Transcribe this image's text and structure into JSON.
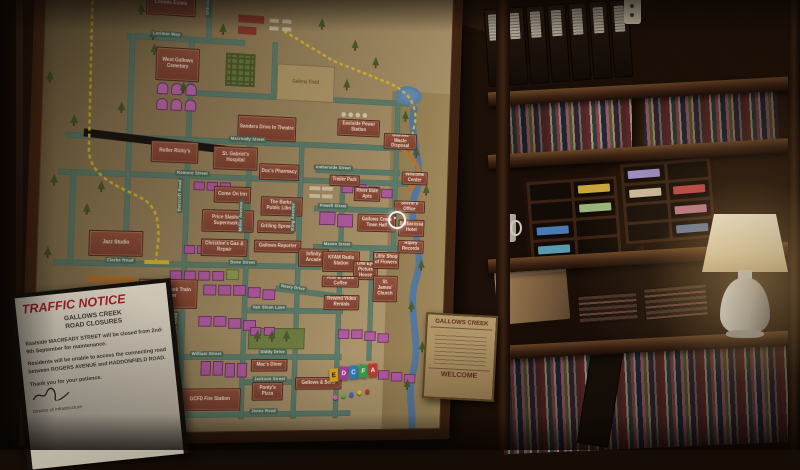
{
  "map": {
    "palette": {
      "paper": "#a9936a",
      "building": "#8a4a38",
      "house": "#b05aa0",
      "road": "#5e7d6b",
      "closed_road": "#191410",
      "detour_route": "#d8b92a",
      "river": "#54779e",
      "rail": "#b8742c"
    },
    "buildings": [
      {
        "label": "Loomis Estate",
        "css": "left:114px;top:42px;width:52px;height:24px"
      },
      {
        "label": "West Gallows Cemetary",
        "css": "left:126px;top:98px;width:46px;height:34px"
      },
      {
        "label": "Roller Ricky's",
        "css": "left:124px;top:193px;width:50px;height:22px"
      },
      {
        "label": "Jazz Studio",
        "css": "left:63px;top:285px;width:56px;height:26px"
      },
      {
        "label": "Gallows Creek Train Station",
        "css": "left:116px;top:333px;width:62px;height:30px"
      },
      {
        "label": "Sanders Drive In Theatre",
        "css": "left:215px;top:163px;width:64px;height:26px"
      },
      {
        "label": "St. Gabriel's Hospital",
        "css": "left:190px;top:196px;width:48px;height:24px"
      },
      {
        "label": "Doc's Pharmacy",
        "css": "left:240px;top:212px;width:44px;height:17px"
      },
      {
        "label": "Come On Inn",
        "css": "left:192px;top:237px;width:40px;height:17px"
      },
      {
        "label": "Price Slashers Supermarket",
        "css": "left:180px;top:261px;width:56px;height:23px"
      },
      {
        "label": "Christine's Gas & Repair",
        "css": "left:180px;top:291px;width:50px;height:18px"
      },
      {
        "label": "The Barker Public Library",
        "css": "left:243px;top:246px;width:46px;height:20px"
      },
      {
        "label": "Grilling Spree",
        "css": "left:240px;top:271px;width:40px;height:13px"
      },
      {
        "label": "Gallows Reporter",
        "css": "left:237px;top:291px;width:52px;height:13px"
      },
      {
        "label": "Eastside Power Station",
        "css": "left:325px;top:162px;width:48px;height:18px"
      },
      {
        "label": "Trailer Park",
        "css": "left:318px;top:221px;width:34px;height:12px"
      },
      {
        "label": "Gallows Waste Disposal",
        "css": "left:378px;top:175px;width:38px;height:17px"
      },
      {
        "label": "Welcome Center",
        "css": "left:400px;top:215px;width:30px;height:14px"
      },
      {
        "label": "River Side Apts",
        "css": "left:346px;top:233px;width:30px;height:15px"
      },
      {
        "label": "Gallows Creek Town Hall",
        "css": "left:351px;top:261px;width:44px;height:19px"
      },
      {
        "label": "Barbarossa Hotel",
        "css": "left:398px;top:266px;width:30px;height:18px"
      },
      {
        "label": "Ripley Records",
        "css": "left:398px;top:288px;width:30px;height:14px"
      },
      {
        "label": "Sheriff's Office",
        "css": "left:392px;top:246px;width:36px;height:13px"
      },
      {
        "label": "Infinity Arcade",
        "css": "left:286px;top:299px;width:34px;height:19px"
      },
      {
        "label": "KFAM Radio Station",
        "css": "left:313px;top:301px;width:42px;height:22px"
      },
      {
        "label": "One Eye Picture House",
        "css": "left:348px;top:311px;width:28px;height:20px"
      },
      {
        "label": "Little Shop of Flowers",
        "css": "left:370px;top:301px;width:30px;height:18px"
      },
      {
        "label": "Rise & Shine Coffee",
        "css": "left:313px;top:327px;width:42px;height:12px"
      },
      {
        "label": "St. James' Church",
        "css": "left:371px;top:326px;width:28px;height:28px"
      },
      {
        "label": "Rewind Video Rentals",
        "css": "left:316px;top:347px;width:40px;height:16px"
      },
      {
        "label": "Mac's Diner",
        "css": "left:238px;top:414px;width:40px;height:13px"
      },
      {
        "label": "Ponty's Pizza",
        "css": "left:240px;top:438px;width:34px;height:19px"
      },
      {
        "label": "GCFD Fire Station",
        "css": "left:162px;top:444px;width:66px;height:23px"
      },
      {
        "label": "Gallows & Sons",
        "css": "left:287px;top:433px;width:52px;height:13px"
      },
      {
        "label": "Galens Field",
        "cls": "field",
        "css": "left:256px;top:108px;width:64px;height:38px"
      }
    ],
    "streets": [
      {
        "label": "Lorimer Way",
        "css": "left:120px;top:82px"
      },
      {
        "label": "Oldridge Road",
        "cls": "vert",
        "css": "left:176px;top:28px"
      },
      {
        "label": "Macready Street",
        "css": "left:206px;top:185px"
      },
      {
        "label": "Romero Street",
        "css": "left:150px;top:222px"
      },
      {
        "label": "Barcroft Road",
        "cls": "vert",
        "css": "left:153px;top:230px"
      },
      {
        "label": "Miller Avenue",
        "cls": "vert",
        "css": "left:219px;top:250px"
      },
      {
        "label": "King Avenue",
        "cls": "vert",
        "css": "left:276px;top:250px"
      },
      {
        "label": "Clarke Road",
        "css": "left:80px;top:312px"
      },
      {
        "label": "Bone Street",
        "css": "left:210px;top:312px"
      },
      {
        "label": "Thorndale Road",
        "cls": "vert",
        "css": "left:153px;top:365px"
      },
      {
        "label": "Van Sloan Lane",
        "css": "left:236px;top:358px"
      },
      {
        "label": "Neary Drive",
        "css": "left:266px;top:337px;transform:rotate(7deg)"
      },
      {
        "label": "William Street",
        "css": "left:172px;top:406px"
      },
      {
        "label": "Diddy Drive",
        "css": "left:246px;top:404px"
      },
      {
        "label": "Jackson Street",
        "css": "left:240px;top:432px"
      },
      {
        "label": "Jones Road",
        "css": "left:238px;top:465px"
      },
      {
        "label": "Mason Street",
        "css": "left:312px;top:291px"
      },
      {
        "label": "Powell Street",
        "css": "left:306px;top:251px"
      },
      {
        "label": "Amberside Street",
        "css": "left:300px;top:211px"
      }
    ],
    "roads": [
      {
        "css": "left:95px;top:86px;width:125px;height:6px"
      },
      {
        "css": "left:160px;top:140px;width:246px;height:6px"
      },
      {
        "css": "left:36px;top:188px;width:372px;height:6px"
      },
      {
        "css": "left:30px;top:225px;width:378px;height:6px"
      },
      {
        "css": "left:28px;top:315px;width:284px;height:6px"
      },
      {
        "css": "left:228px;top:361px;width:110px;height:6px"
      },
      {
        "css": "left:148px;top:409px;width:190px;height:6px"
      },
      {
        "css": "left:228px;top:435px;width:110px;height:6px"
      },
      {
        "css": "left:148px;top:468px;width:202px;height:6px"
      },
      {
        "css": "left:262px;top:342px;width:76px;height:6px;transform:rotate(6deg)"
      },
      {
        "css": "left:302px;top:294px;width:96px;height:6px"
      },
      {
        "css": "left:302px;top:254px;width:96px;height:6px"
      },
      {
        "css": "left:302px;top:214px;width:96px;height:6px"
      },
      {
        "css": "left:98px;top:86px;width:6px;height:234px"
      },
      {
        "css": "left:160px;top:86px;width:6px;height:390px"
      },
      {
        "css": "left:226px;top:188px;width:6px;height:288px"
      },
      {
        "css": "left:283px;top:188px;width:6px;height:288px"
      },
      {
        "css": "left:330px;top:214px;width:6px;height:262px"
      },
      {
        "css": "left:366px;top:294px;width:6px;height:122px"
      },
      {
        "css": "left:178px;top:14px;width:6px;height:76px"
      },
      {
        "css": "left:390px;top:140px;width:6px;height:158px"
      },
      {
        "css": "left:250px;top:86px;width:6px;height:58px"
      },
      {
        "css": "left:42px;top:225px;width:6px;height:94px"
      }
    ],
    "deco": [
      {
        "cls": "band",
        "css": "left:386px;top:130px;width:67px;height:359px"
      },
      {
        "cls": "lake",
        "css": "left:390px;top:124px;width:30px;height:20px"
      },
      {
        "cls": "maze",
        "css": "left:200px;top:100px;width:32px;height:34px"
      },
      {
        "cls": "park",
        "css": "left:234px;top:382px;width:62px;height:22px"
      },
      {
        "cls": "redbox",
        "css": "left:212px;top:60px;width:28px;height:8px"
      },
      {
        "cls": "redbox",
        "css": "left:212px;top:72px;width:20px;height:8px"
      },
      {
        "cls": "wbar",
        "css": "left:246px;top:62px;width:10px;height:4px"
      },
      {
        "cls": "wbar",
        "css": "left:260px;top:62px;width:10px;height:4px"
      },
      {
        "cls": "wbar",
        "css": "left:246px;top:70px;width:10px;height:4px"
      },
      {
        "cls": "wbar",
        "css": "left:260px;top:70px;width:10px;height:4px"
      },
      {
        "cls": "wbar",
        "css": "left:296px;top:234px;width:12px;height:4px"
      },
      {
        "cls": "wbar",
        "css": "left:310px;top:234px;width:12px;height:4px"
      },
      {
        "cls": "wbar",
        "css": "left:296px;top:242px;width:12px;height:4px"
      },
      {
        "cls": "wbar",
        "css": "left:310px;top:242px;width:12px;height:4px"
      },
      {
        "cls": "dot",
        "css": "left:329px;top:155px;width:5px;height:5px"
      },
      {
        "cls": "dot",
        "css": "left:337px;top:155px;width:5px;height:5px"
      },
      {
        "cls": "dot",
        "css": "left:345px;top:155px;width:5px;height:5px"
      },
      {
        "cls": "dot",
        "css": "left:353px;top:155px;width:5px;height:5px"
      },
      {
        "cls": "rail",
        "css": "left:62px;top:331px;width:50px;height:6px"
      },
      {
        "cls": "rail",
        "css": "left:84px;top:331px;width:8px;height:44px"
      },
      {
        "cls": "closed",
        "css": "left:54px;top:190px;width:154px;height:8px;transform:rotate(4.5deg)"
      }
    ],
    "houses": [
      {
        "cls": "tomb",
        "css": "left:128px;top:134px;width:12px;height:12px"
      },
      {
        "cls": "tomb",
        "css": "left:143px;top:134px;width:12px;height:12px"
      },
      {
        "cls": "tomb",
        "css": "left:158px;top:134px;width:12px;height:12px"
      },
      {
        "cls": "tomb",
        "css": "left:128px;top:150px;width:12px;height:12px"
      },
      {
        "cls": "tomb",
        "css": "left:143px;top:150px;width:12px;height:12px"
      },
      {
        "cls": "tomb",
        "css": "left:158px;top:150px;width:12px;height:12px"
      },
      {
        "css": "left:170px;top:233px;width:12px;height:9px"
      },
      {
        "css": "left:184px;top:233px;width:12px;height:9px"
      },
      {
        "css": "left:198px;top:233px;width:12px;height:9px"
      },
      {
        "css": "left:162px;top:298px;width:12px;height:9px"
      },
      {
        "css": "left:176px;top:298px;width:12px;height:9px"
      },
      {
        "css": "left:190px;top:298px;width:12px;height:9px"
      },
      {
        "css": "left:148px;top:324px;width:13px;height:10px"
      },
      {
        "css": "left:163px;top:324px;width:13px;height:10px"
      },
      {
        "css": "left:178px;top:324px;width:13px;height:10px"
      },
      {
        "css": "left:193px;top:324px;width:13px;height:10px"
      },
      {
        "cls": "park2",
        "css": "left:208px;top:322px;width:14px;height:11px"
      },
      {
        "css": "left:184px;top:338px;width:14px;height:11px"
      },
      {
        "css": "left:200px;top:338px;width:14px;height:11px"
      },
      {
        "css": "left:216px;top:338px;width:14px;height:11px"
      },
      {
        "css": "left:232px;top:340px;width:14px;height:11px"
      },
      {
        "css": "left:248px;top:342px;width:14px;height:11px"
      },
      {
        "css": "left:180px;top:370px;width:14px;height:11px"
      },
      {
        "css": "left:196px;top:370px;width:14px;height:11px"
      },
      {
        "css": "left:212px;top:372px;width:14px;height:11px"
      },
      {
        "css": "left:228px;top:374px;width:14px;height:11px"
      },
      {
        "css": "left:184px;top:416px;width:11px;height:15px"
      },
      {
        "css": "left:197px;top:416px;width:11px;height:15px"
      },
      {
        "css": "left:210px;top:418px;width:11px;height:15px"
      },
      {
        "css": "left:223px;top:418px;width:11px;height:15px"
      },
      {
        "css": "left:56px;top:446px;width:13px;height:11px"
      },
      {
        "css": "left:72px;top:446px;width:13px;height:11px"
      },
      {
        "css": "left:88px;top:448px;width:13px;height:11px"
      },
      {
        "css": "left:104px;top:448px;width:13px;height:11px"
      },
      {
        "css": "left:40px;top:478px;width:13px;height:11px"
      },
      {
        "css": "left:58px;top:478px;width:13px;height:11px"
      },
      {
        "css": "left:76px;top:480px;width:13px;height:11px"
      },
      {
        "css": "left:332px;top:230px;width:13px;height:10px"
      },
      {
        "css": "left:347px;top:230px;width:13px;height:10px"
      },
      {
        "css": "left:362px;top:232px;width:13px;height:10px"
      },
      {
        "css": "left:377px;top:234px;width:13px;height:10px"
      },
      {
        "css": "left:308px;top:260px;width:18px;height:14px"
      },
      {
        "css": "left:328px;top:262px;width:18px;height:14px"
      },
      {
        "css": "left:333px;top:383px;width:13px;height:10px"
      },
      {
        "css": "left:348px;top:383px;width:13px;height:10px"
      },
      {
        "css": "left:363px;top:385px;width:13px;height:10px"
      },
      {
        "css": "left:378px;top:387px;width:13px;height:10px"
      },
      {
        "css": "left:380px;top:426px;width:13px;height:10px"
      },
      {
        "css": "left:395px;top:428px;width:13px;height:10px"
      },
      {
        "css": "left:410px;top:430px;width:13px;height:10px"
      },
      {
        "css": "left:236px;top:381px;width:12px;height:9px"
      },
      {
        "css": "left:251px;top:381px;width:12px;height:9px"
      }
    ],
    "trees": [
      {
        "css": "left:14px;top:128px"
      },
      {
        "css": "left:40px;top:170px"
      },
      {
        "css": "left:22px;top:230px"
      },
      {
        "css": "left:56px;top:258px"
      },
      {
        "css": "left:18px;top:302px"
      },
      {
        "css": "left:70px;top:235px"
      },
      {
        "css": "left:88px;top:155px"
      },
      {
        "css": "left:118px;top:80px"
      },
      {
        "css": "left:105px;top:55px"
      },
      {
        "css": "left:152px;top:132px"
      },
      {
        "css": "left:120px;top:95px"
      },
      {
        "css": "left:192px;top:70px"
      },
      {
        "css": "left:300px;top:58px"
      },
      {
        "css": "left:338px;top:78px"
      },
      {
        "css": "left:362px;top:95px"
      },
      {
        "css": "left:330px;top:120px"
      },
      {
        "css": "left:398px;top:150px"
      },
      {
        "css": "left:412px;top:188px"
      },
      {
        "css": "left:425px;top:228px"
      },
      {
        "css": "left:408px;top:268px"
      },
      {
        "css": "left:422px;top:308px"
      },
      {
        "css": "left:412px;top:352px"
      },
      {
        "css": "left:426px;top:395px"
      },
      {
        "css": "left:410px;top:435px"
      },
      {
        "css": "left:240px;top:384px"
      },
      {
        "css": "left:256px;top:384px"
      },
      {
        "css": "left:272px;top:384px"
      }
    ],
    "legend_tiles": [
      {
        "letter": "E",
        "color": "#d8a622",
        "text_color": "#241a06",
        "css": "left:325px;top:424px;transform:rotate(-5deg)"
      },
      {
        "letter": "D",
        "color": "#a43f98",
        "css": "left:336px;top:422px;transform:rotate(4deg)"
      },
      {
        "letter": "C",
        "color": "#2d7fb8",
        "css": "left:347px;top:421px;transform:rotate(-3deg)"
      },
      {
        "letter": "F",
        "color": "#3f9a4e",
        "css": "left:358px;top:420px;transform:rotate(5deg)"
      },
      {
        "letter": "A",
        "color": "#c03a36",
        "css": "left:369px;top:419px;transform:rotate(-4deg)"
      }
    ],
    "pins": [
      {
        "color": "#d864b8",
        "css": "left:330px;top:452px"
      },
      {
        "color": "#58b84e",
        "css": "left:339px;top:450px"
      },
      {
        "color": "#3a6fd8",
        "css": "left:348px;top:449px"
      },
      {
        "color": "#d8c030",
        "css": "left:357px;top:447px"
      },
      {
        "color": "#c03a36",
        "css": "left:366px;top:446px"
      }
    ]
  },
  "traffic_notice": {
    "title": "TRAFFIC NOTICE",
    "subtitle_line1": "GALLOWS CREEK",
    "subtitle_line2": "ROAD CLOSURES",
    "paragraph1": "Eastside MACREADY STREET will be closed from 2nd-9th September for maintenance.",
    "paragraph2": "Residents will be unable to access the connecting road between ROGERS AVENUE and HADDONFIELD ROAD.",
    "paragraph3": "Thank you for your patience.",
    "footer": "Director of Infrastructure",
    "accent_color": "#9e1f24"
  },
  "welcome_poster": {
    "title": "GALLOWS CREEK",
    "footer": "WELCOME"
  }
}
